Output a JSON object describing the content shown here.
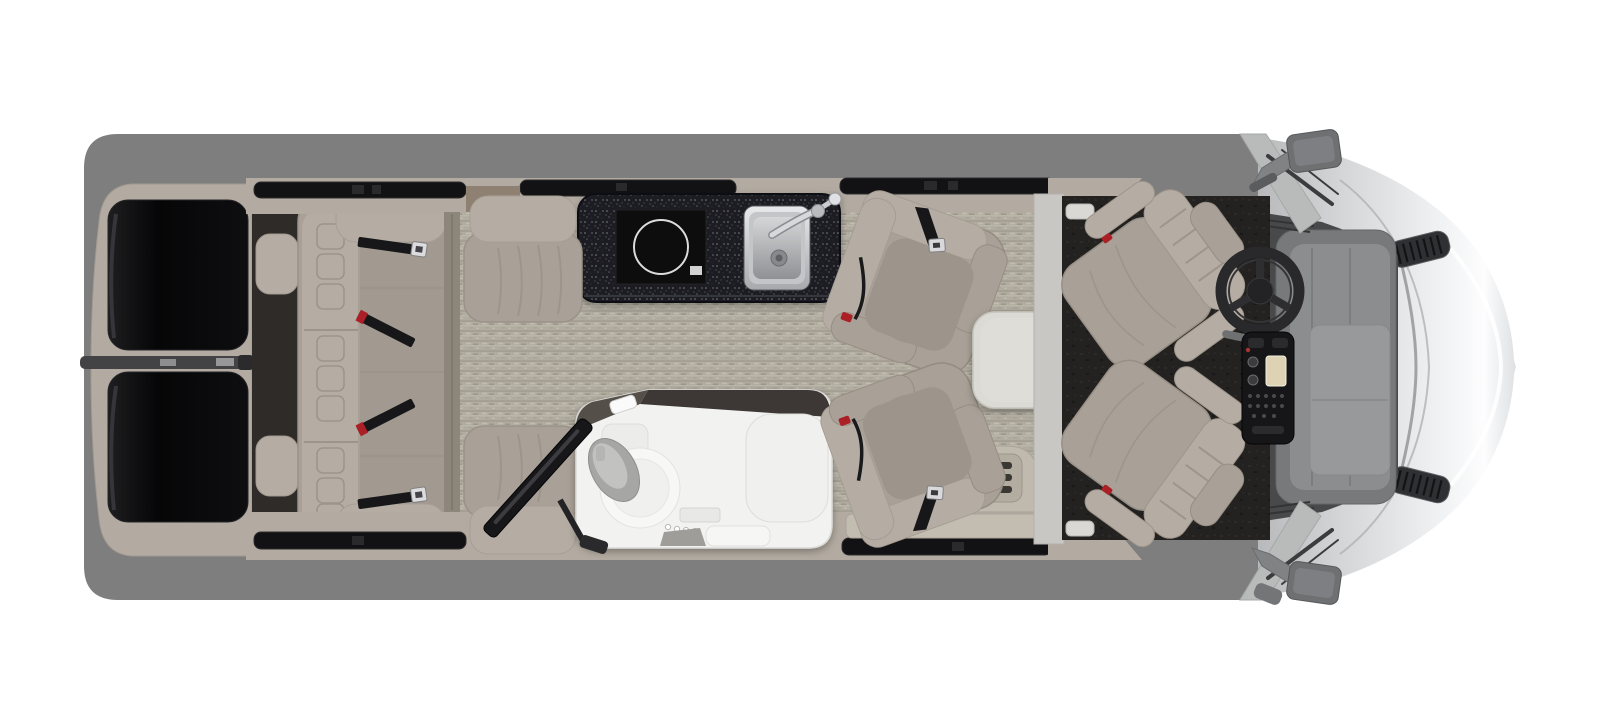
{
  "image": {
    "type": "rv-floorplan-top-view",
    "alt": "Top-down cutaway floor plan rendering of a Class B touring motorhome",
    "background": "#ffffff"
  },
  "palette": {
    "roof_gray": "#7e7e7e",
    "body_silver": "#d9dbdd",
    "wall_beige": "#b3aba1",
    "upholstery": "#a9a197",
    "upholstery_dark": "#9d958b",
    "upholstery_light": "#b5ada3",
    "carpet_base": "#b1aca0",
    "counter_black": "#1d1f22",
    "cooktop_black": "#0b0b0c",
    "steel": "#c6c8cb",
    "bathroom_white": "#f2f2f1",
    "window_black": "#121214",
    "cab_floor": "#242220",
    "belt_black": "#17171a",
    "buckle_red": "#ab2027",
    "table_top": "#dbdad5",
    "dash_gray": "#8b8d8f",
    "pillar_gray": "#c8c7c3"
  },
  "components": {
    "rear_doors": {
      "label": "Rear doors with tinted windows",
      "window_count": 2
    },
    "rear_sofa": {
      "label": "Rear bench sofa with four seat belts",
      "seatbelt_count": 4
    },
    "jump_seat_top": {
      "label": "Single seat, driver side"
    },
    "jump_seat_bottom": {
      "label": "Single seat, door side"
    },
    "tv": {
      "label": "Swing-out TV on articulating mount"
    },
    "galley": {
      "label": "Galley counter",
      "items": [
        "induction cooktop",
        "stainless sink with faucet"
      ],
      "burner_count": 1
    },
    "bathroom": {
      "label": "Wet bath",
      "items": [
        "toilet",
        "shower bench",
        "vanity sink"
      ]
    },
    "lounge_chair_top": {
      "label": "Swivel lounge chair, rear facing"
    },
    "lounge_chair_bottom": {
      "label": "Swivel lounge chair, door side"
    },
    "table": {
      "label": "Removable pedestal table"
    },
    "entry_step": {
      "label": "Sliding-door entry step"
    },
    "cab_seat_top": {
      "label": "Driver cab seat, swiveled"
    },
    "cab_seat_bottom": {
      "label": "Passenger cab seat, swiveled"
    },
    "cockpit": {
      "label": "Cockpit with steering wheel and center console"
    },
    "hood": {
      "label": "Van hood and front fascia"
    },
    "mirror_top": {
      "label": "Driver side mirror"
    },
    "mirror_bottom": {
      "label": "Passenger side mirror"
    }
  }
}
